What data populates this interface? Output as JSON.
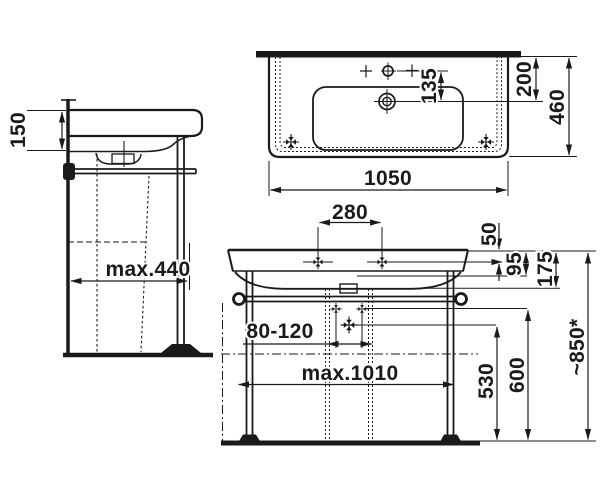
{
  "colors": {
    "ink": "#1a1a1a",
    "background": "#ffffff"
  },
  "labels": {
    "side_view": {
      "rim_height": "150",
      "wall_clearance": "max.440"
    },
    "top_view": {
      "tap_to_drain": "135",
      "edge_to_drain": "200",
      "overall_depth": "460",
      "overall_width": "1050"
    },
    "front_view": {
      "tap_hole_spacing": "280",
      "edge_to_fixings": "50",
      "apron_height": "95",
      "body_height": "175",
      "waste_offset_range": "80-120",
      "frame_width": "max.1010",
      "trap_height": "530",
      "valve_height": "600",
      "overall_height": "~850*"
    }
  }
}
